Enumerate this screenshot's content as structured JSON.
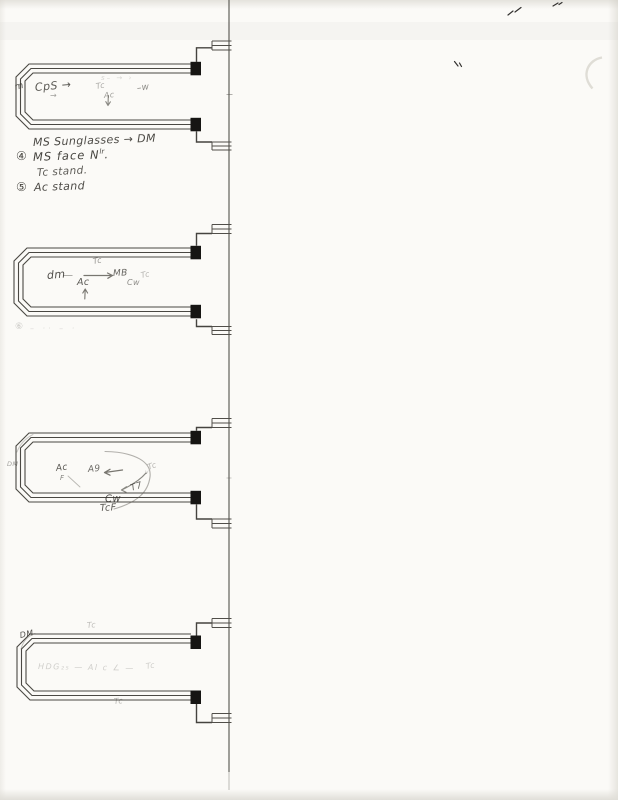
{
  "page": {
    "background": "#fbfaf7",
    "ink_color": "#4a4843",
    "pencil_color": "#57554e",
    "square_color": "#161513"
  },
  "annotations": {
    "loop1": {
      "edge_mark": "m",
      "cps_arrow": "CpS →",
      "small_arrow": "→",
      "faint_scribble": "s– → ›",
      "tc": "Tc",
      "ac": "Ac",
      "minus_w": "–w"
    },
    "notes": {
      "line1": "MS Sunglasses → DM",
      "line2_bullet": "④",
      "line2_text": "MS face N",
      "line2_sup": "lr",
      "line2_period": ".",
      "line3": "Tc stand.",
      "line4_bullet": "⑤",
      "line4_text": "Ac stand"
    },
    "loop2": {
      "edge_mark": "dm",
      "tc_top": "Tc",
      "dash": "—",
      "ac": "Ac",
      "mb": "MB",
      "cw": "Cw",
      "tc_right": "Tc",
      "below_bullet": "⑥",
      "below_scribble": "– ·· – ·"
    },
    "loop3": {
      "edge_mark": "DM",
      "ac": "Ac",
      "f": "F",
      "a9": "A9",
      "v": "v",
      "tc_right": "Tc",
      "t7": "T7",
      "cw": "Cw",
      "tcf": "TcF"
    },
    "loop4": {
      "edge_mark": "DM",
      "tc_top": "Tc",
      "interior_faint": "HDG₂₅ — Al c ∠ —",
      "tc_right_faint": "Tc",
      "tc_bottom": "Tc"
    }
  }
}
